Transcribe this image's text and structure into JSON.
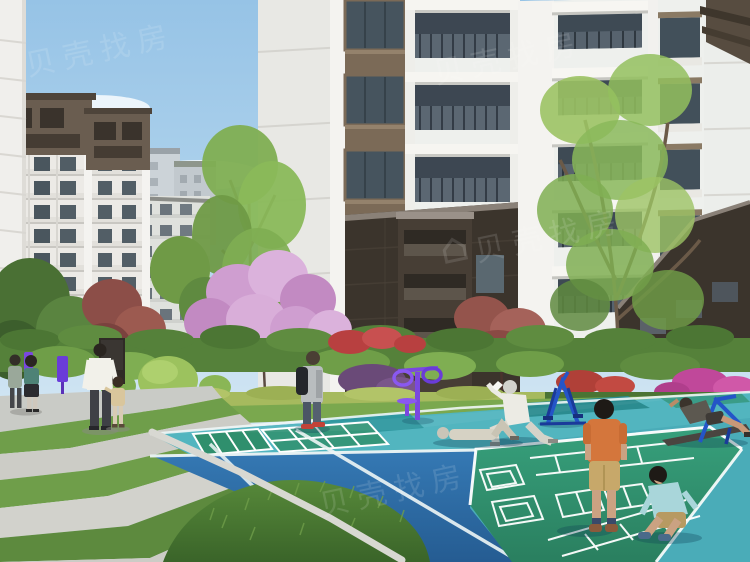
{
  "watermark": {
    "text": "贝壳找房",
    "logo": "house-icon",
    "color": "#ffffff",
    "opacity": 0.12
  },
  "scene": {
    "setting": "residential-complex-courtyard-architectural-rendering",
    "sky": {
      "top": "#96c3e6",
      "horizon": "#e3eef6",
      "clouds": 4
    },
    "buildings": [
      {
        "name": "left-midrise-brown-roof",
        "facade": "#ece9e4",
        "roof": "#6a5d50"
      },
      {
        "name": "left-midrise-rear",
        "facade": "#dfe1dd"
      },
      {
        "name": "background-block",
        "facade": "#c9d0d5"
      },
      {
        "name": "center-tower",
        "facade": "#f2f1ee",
        "podium": "#3b342c",
        "window_frame": "#7b6a57"
      },
      {
        "name": "right-tower",
        "facade": "#eef0ed",
        "podium": "#3b342c"
      },
      {
        "name": "left-edge-building",
        "facade": "#f0efec"
      }
    ],
    "vegetation": [
      {
        "name": "pink-blossom-tree",
        "color": "#cf9ed0"
      },
      {
        "name": "red-maple-left",
        "color": "#8c4e48"
      },
      {
        "name": "red-maple-right",
        "color": "#94544c"
      },
      {
        "name": "bright-green-tree-center",
        "color": "#8ab95a"
      },
      {
        "name": "large-green-tree-right",
        "color": "#9cc364"
      },
      {
        "name": "red-flower-bushes",
        "color": "#b84040"
      },
      {
        "name": "magenta-flower-bush",
        "color": "#c0489a"
      },
      {
        "name": "purple-bush",
        "color": "#6a4a78"
      },
      {
        "name": "hedges",
        "color": "#5a8a3c"
      },
      {
        "name": "grass-mound",
        "color": "#3f6b2c"
      }
    ],
    "court": {
      "teal": "#4aacb8",
      "blue": "#2e6fa8",
      "green": "#2f8f6d",
      "lines": "#ffffff"
    },
    "pavers": {
      "concrete": "#c9c9c3",
      "grass": "#6f9e4a"
    },
    "people": [
      {
        "name": "walking-couple-far-left",
        "colors": [
          "#4e8276",
          "#9aa89a"
        ]
      },
      {
        "name": "man-white-shirt",
        "shirt": "#f2f1ea",
        "pants": "#3f4046"
      },
      {
        "name": "little-girl-tan",
        "outfit": "#d9c69c"
      },
      {
        "name": "backpack-pedestrian",
        "top": "#b9bdbf",
        "backpack": "#24272c",
        "shoes": "#c24238"
      },
      {
        "name": "elderly-man-stretching",
        "outfit": "#ecebe4",
        "hair": "#d2d2cc"
      },
      {
        "name": "person-lying-exercising",
        "outfit": "#d6d2c4"
      },
      {
        "name": "man-on-situp-bench",
        "shirt": "#5c5850"
      },
      {
        "name": "boy-orange-shirt",
        "shirt": "#d4763c",
        "shorts": "#c7a86a"
      },
      {
        "name": "boy-blue-shirt-sitting",
        "shirt": "#a9d6da",
        "shorts": "#b79a62"
      }
    ],
    "equipment": [
      {
        "name": "tai-chi-spinner",
        "color": "#7a48e0"
      },
      {
        "name": "air-walker",
        "color": "#2455c8"
      },
      {
        "name": "situp-bench",
        "color": "#2455c8"
      },
      {
        "name": "purple-signpost",
        "color": "#6a3cd8"
      }
    ]
  }
}
